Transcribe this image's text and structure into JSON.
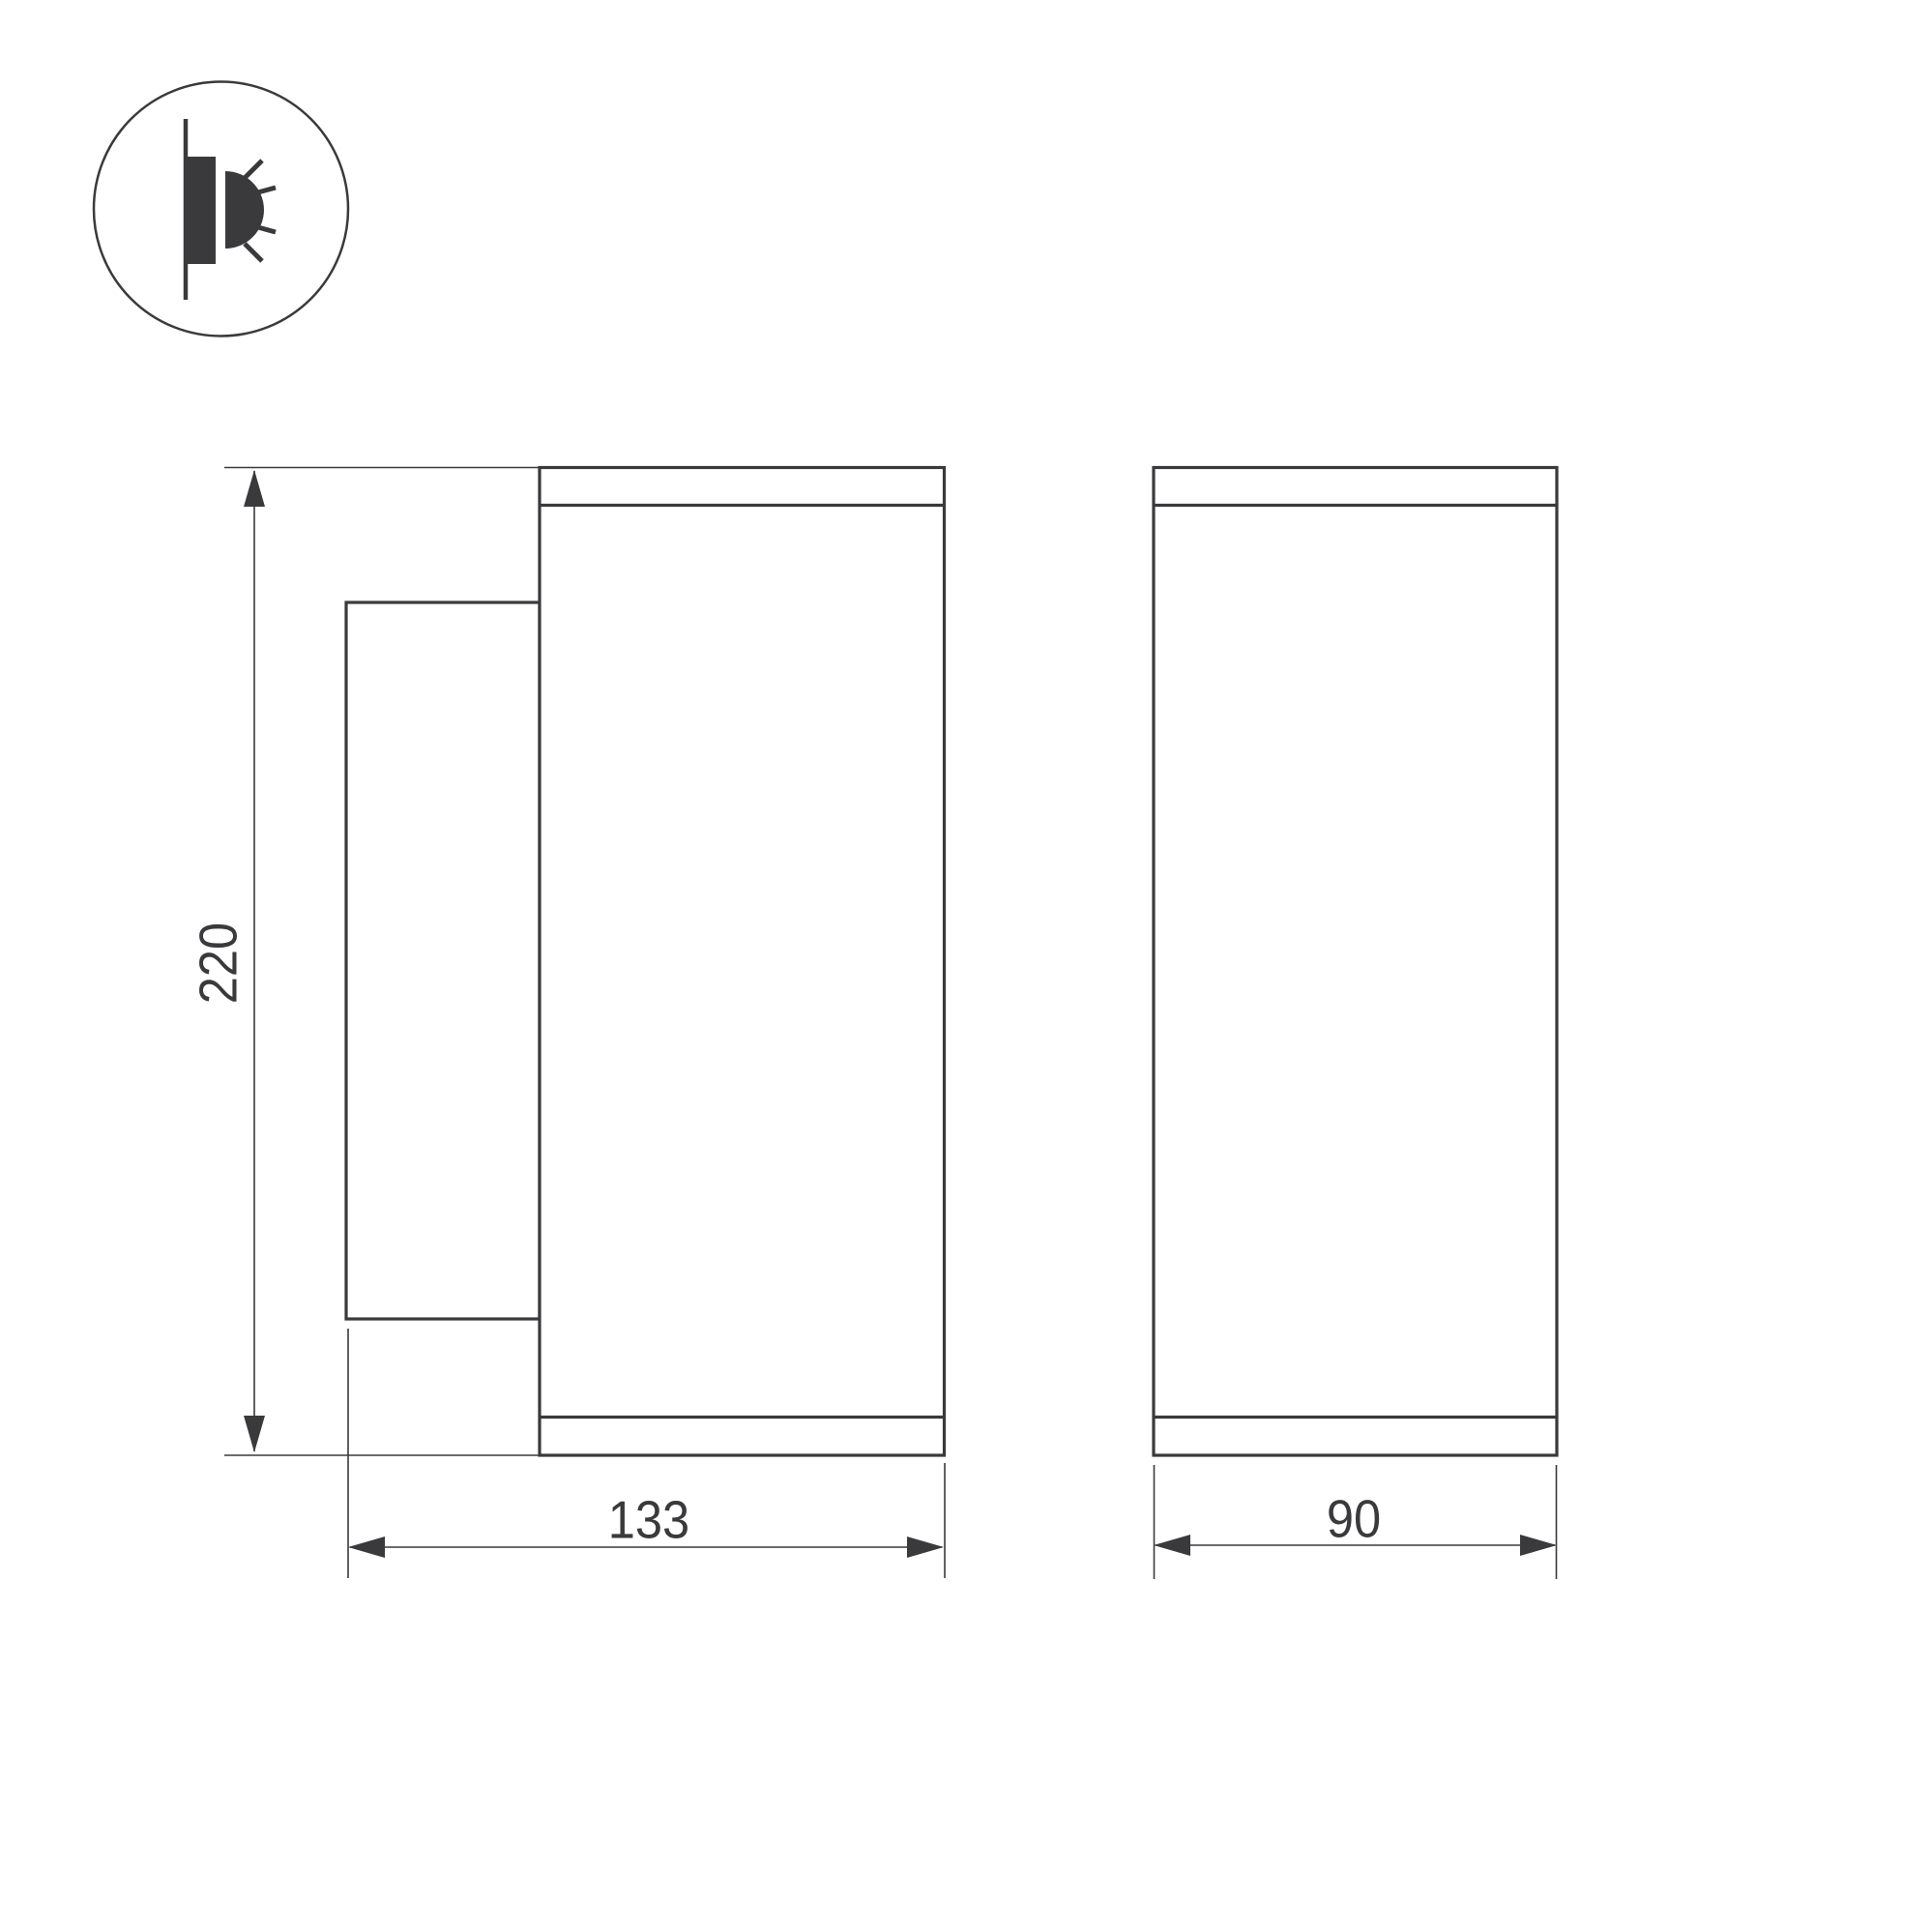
{
  "colors": {
    "line": "#3a3a3c",
    "text": "#3a3a3c",
    "background": "#ffffff"
  },
  "icon": {
    "name": "wall-mounted-light-side-emission-icon"
  },
  "dimensions": {
    "height": "220",
    "depth": "133",
    "width": "90"
  }
}
